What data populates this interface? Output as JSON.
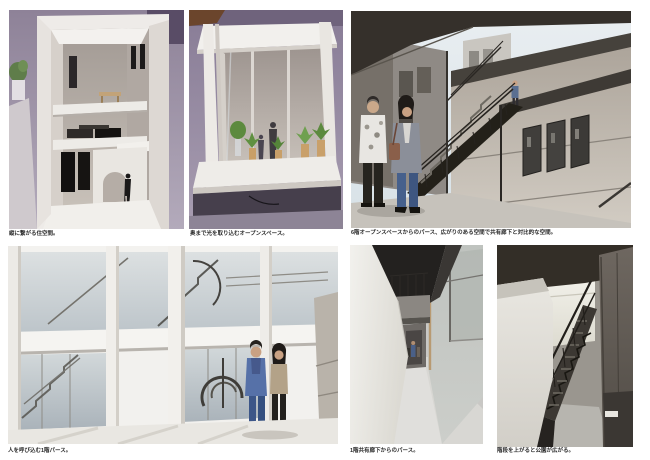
{
  "board": {
    "page_background": "#ffffff",
    "caption_color": "#2b2b2b"
  },
  "panels": [
    {
      "id": "model-vertical-living",
      "kind": "study-model-photo",
      "subject": "white study model of stacked living floors with shelves, black doors and a tiny figure on a lavender backdrop",
      "caption": "縦に繋がる住空間。"
    },
    {
      "id": "model-open-space",
      "kind": "study-model-photo",
      "subject": "white frame model of a tall open space with small plants and dark figures on a platform",
      "caption": "奥まで光を取り込むオープンスペース。"
    },
    {
      "id": "render-6f-open-space",
      "kind": "cg-perspective",
      "subject": "exterior perspective with black steel stair, shared corridor wall with three dark windows, two people in foreground and one on the stair landing",
      "caption": "6階オープンスペースからのパース、広がりのある空間で共有廊下と対比的な空間。"
    },
    {
      "id": "render-1f-entrance",
      "kind": "cg-perspective",
      "subject": "bright ground-floor courtyard with glass walls, white columns, spiral stair and two standing people",
      "caption": "人を呼び込む1階パース。"
    },
    {
      "id": "render-1f-corridor",
      "kind": "cg-perspective",
      "subject": "narrow shared corridor with white wall, dark ceiling, overhanging balcony box and glazing on the right",
      "caption": "1階共有廊下からのパース。"
    },
    {
      "id": "render-stair-to-park",
      "kind": "cg-perspective",
      "subject": "dark steel stair rising toward bright daylight between a white wall and a dark grey wall",
      "caption": "階段を上がると公園が広がる。"
    }
  ]
}
